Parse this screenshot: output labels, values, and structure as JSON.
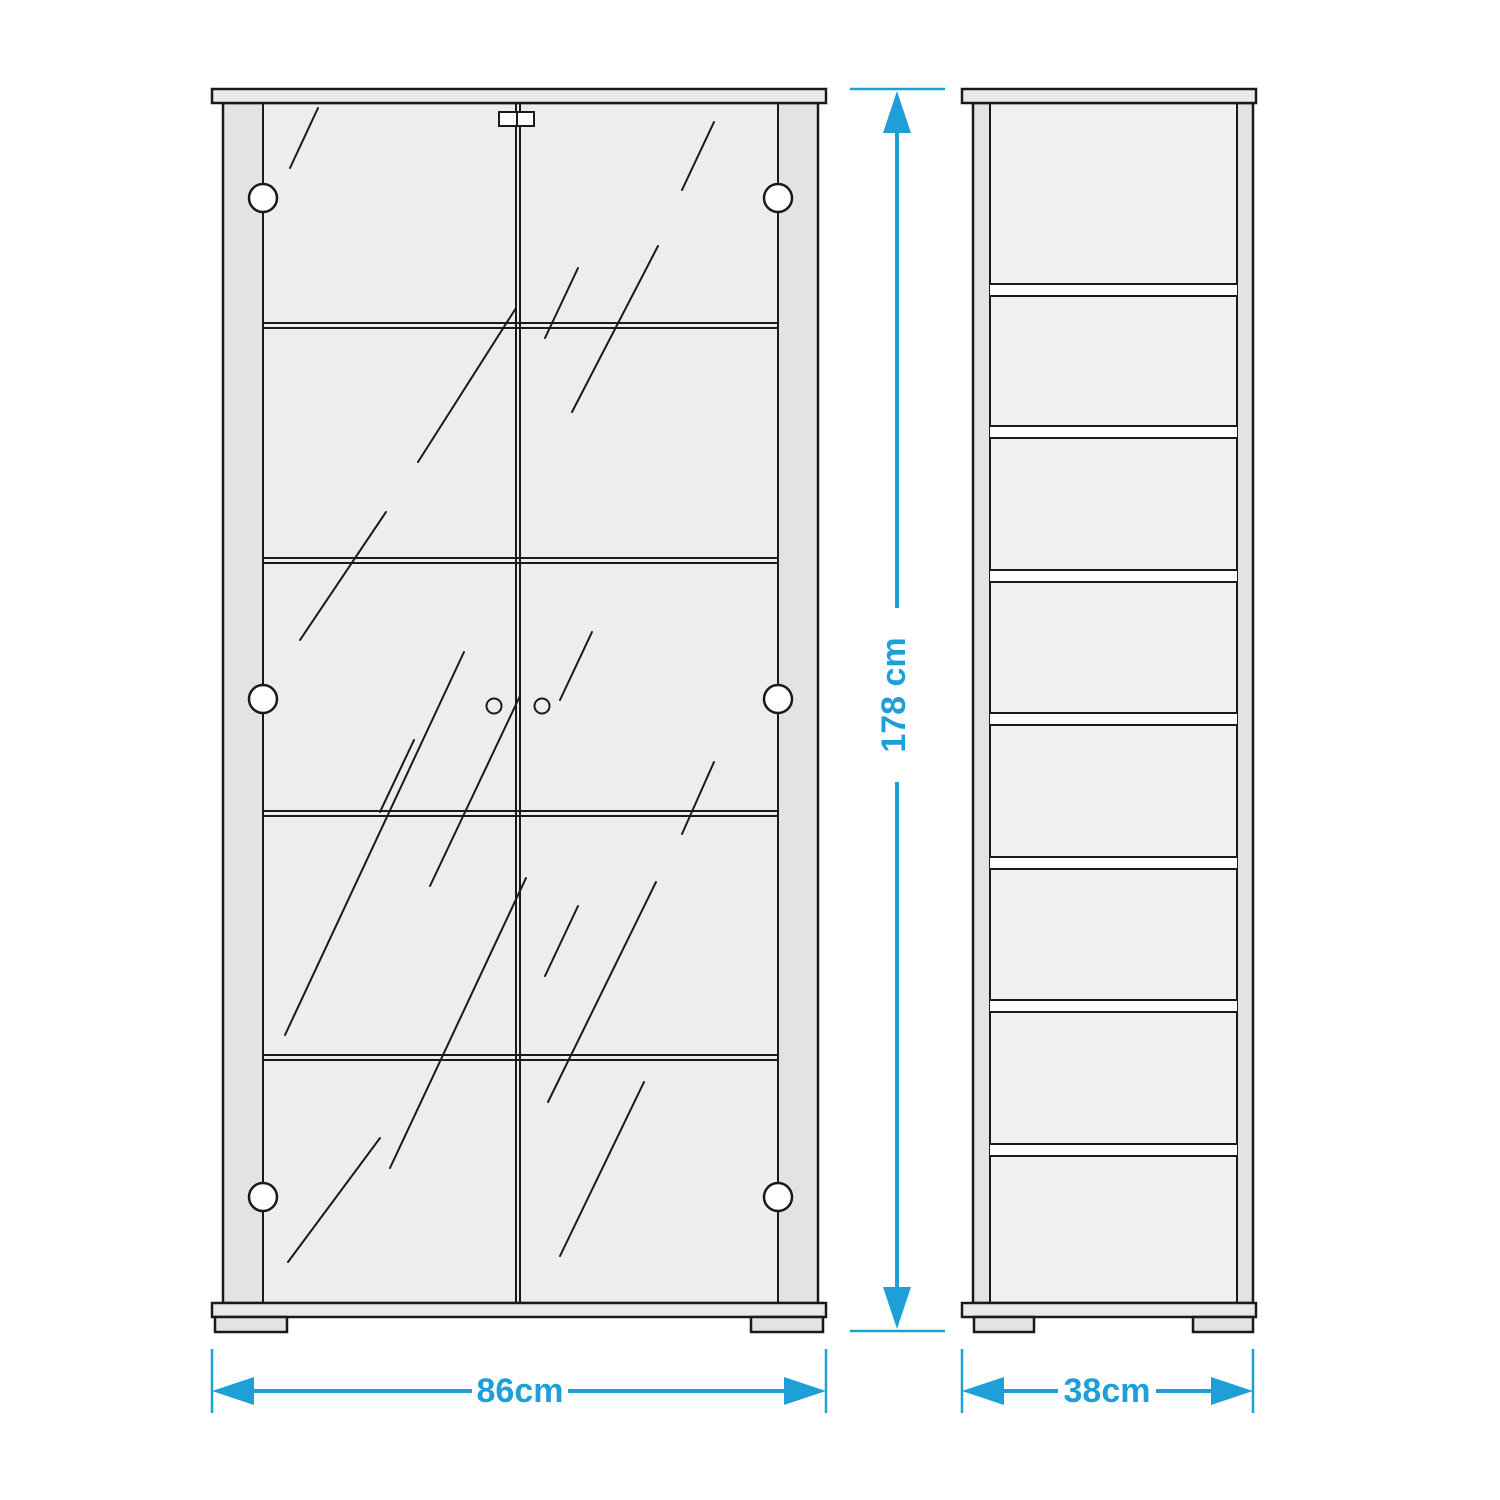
{
  "diagram": {
    "description": "Dimension drawing of a two-door glass display cabinet, front and side elevations",
    "front_view": {
      "name": "front-elevation",
      "doors": 2,
      "door_knobs": 2,
      "hinges_per_side": 3,
      "shelf_lines_visible": 4,
      "width_dimension": {
        "value": "86cm"
      },
      "height_dimension": {
        "value": "178 cm"
      }
    },
    "side_view": {
      "name": "side-elevation",
      "compartments": 8,
      "shelf_edges_visible": 7,
      "depth_dimension": {
        "value": "38cm"
      }
    },
    "colors": {
      "dimension_accent": "#1e9fd7",
      "line": "#1a1a1a",
      "panel_fill": "#e9e9e9",
      "frame_fill": "#e3e3e3",
      "glass_fill": "#ededed",
      "interior_fill": "#f0f0f0",
      "shelf_gap_fill": "#ffffff",
      "background": "#ffffff"
    }
  }
}
